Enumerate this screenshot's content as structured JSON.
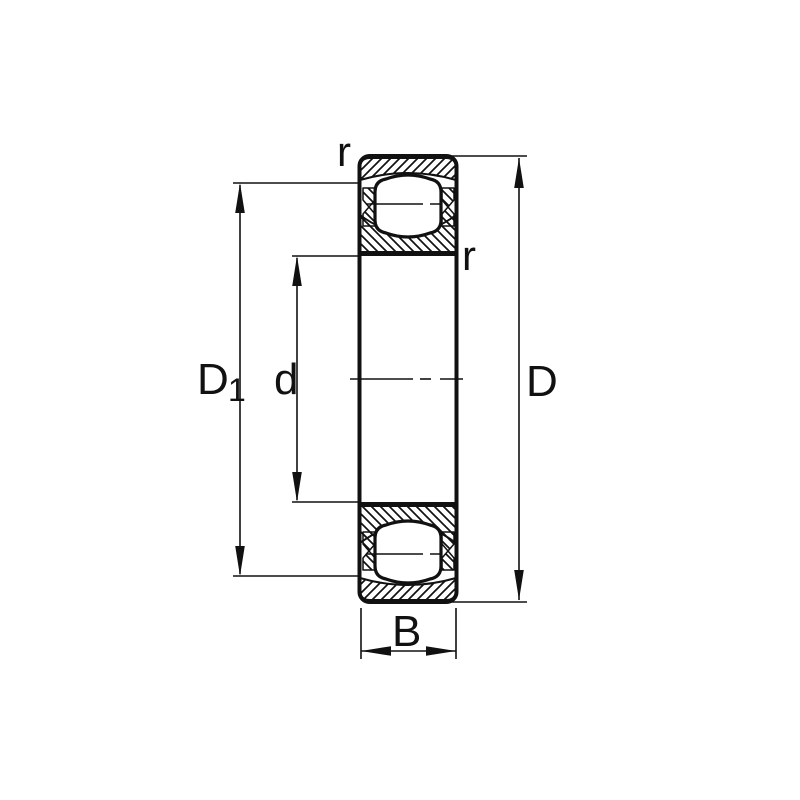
{
  "figure": {
    "kind": "bearing-cross-section-drawing",
    "background_color": "#ffffff",
    "line_color": "#111111",
    "labels": {
      "fillet_radius_top": "r",
      "fillet_radius_side": "r",
      "shoulder_diameter_base": "D",
      "shoulder_diameter_subscript": "1",
      "bore_diameter": "d",
      "outside_diameter": "D",
      "width": "B"
    }
  }
}
